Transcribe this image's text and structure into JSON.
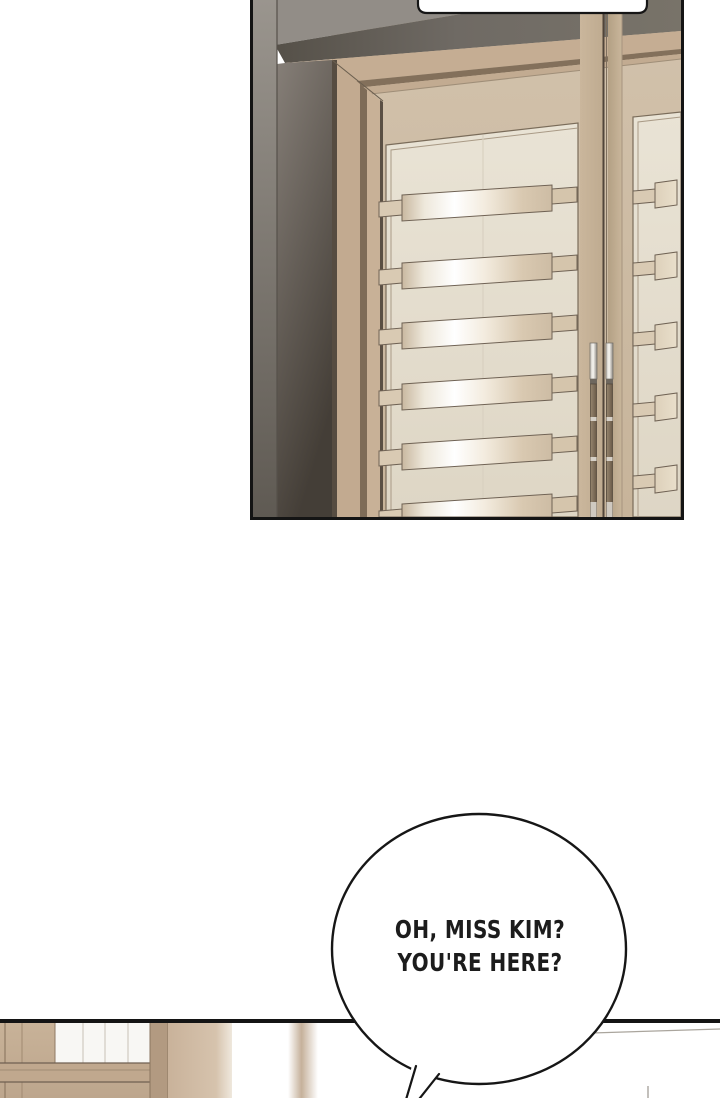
{
  "page": {
    "kind": "webtoon-comic-segment",
    "width_px": 720,
    "height_px": 1098
  },
  "panels": [
    {
      "id": "door-panel",
      "description": "tall wooden double doors with horizontal metallic handle slats, dark wall at left"
    },
    {
      "id": "hallway-panel",
      "description": "partially visible room with wooden cabinetry at left, mostly cropped at bottom edge"
    }
  ],
  "speech": {
    "top_bubble": {
      "text": ""
    },
    "main_bubble": {
      "line1": "OH, MISS KIM?",
      "line2": "YOU'RE HERE?"
    }
  },
  "palette": {
    "background": "#ffffff",
    "panel_border": "#141414",
    "bubble_outline": "#161616",
    "text": "#1c1c1c",
    "wall_dark": "#453f38",
    "wall_light": "#928d87",
    "door_wood": "#cdbca6",
    "door_trim_brown": "#7e6c58",
    "door_inset_panel": "#e5decf",
    "handle_metal": "#f8f6f1",
    "hall_wood": "#c3ac93"
  }
}
